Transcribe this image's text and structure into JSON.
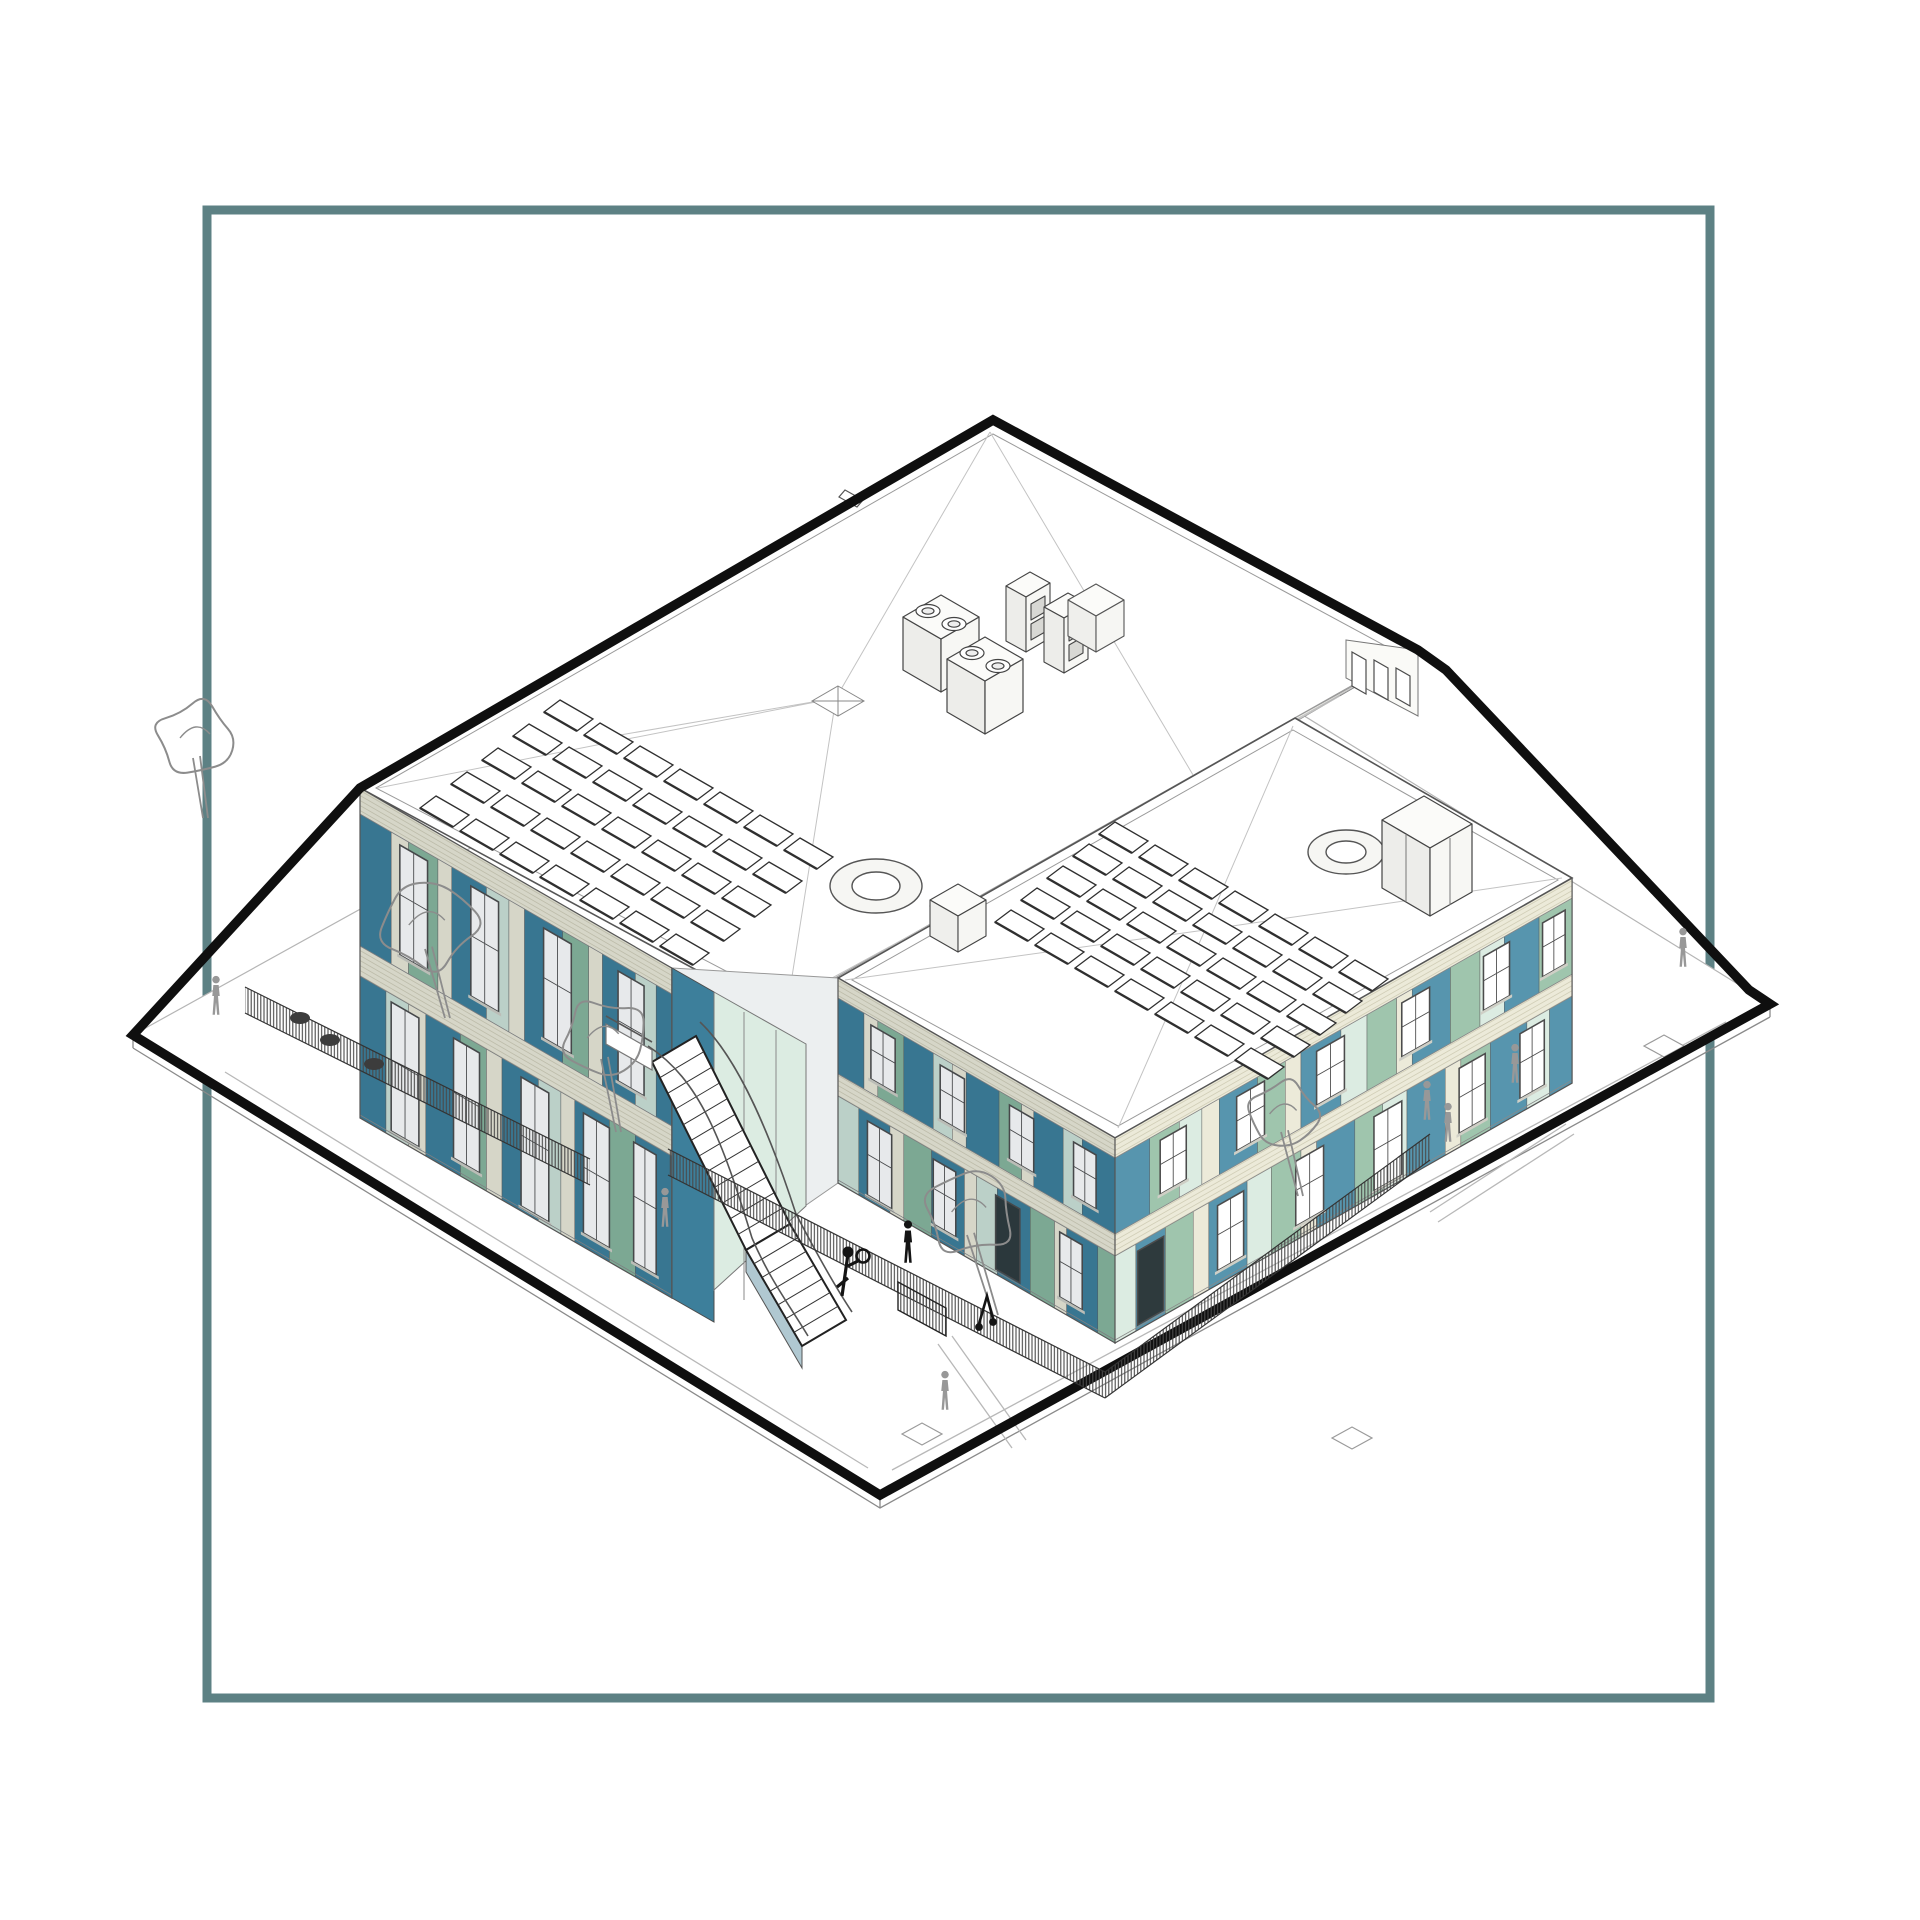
{
  "meta": {
    "label": "Axonometric architectural drawing of a two-storey L-shaped building with coloured facade panels, rooftop solar panels and plant, fenced play areas, trees and people, framed by a square teal border"
  },
  "palette": {
    "background": "#ffffff",
    "frame": "#5d8184",
    "ink": "#0f0f0f",
    "line": "#444444",
    "line_light": "#9a9a9a",
    "roof_line": "#c3c3c3",
    "roof_fill": "#ffffff",
    "teal": "#3d7f9b",
    "teal_light": "#5795ae",
    "sage": "#88b79e",
    "sage_light": "#9fc5ad",
    "mint": "#cfe4d8",
    "mint_light": "#dcece2",
    "cream": "#ecead9",
    "cream_hatch": "#d2cfb8",
    "window_frame": "#4c4c4c",
    "door_dark": "#2e3a3d",
    "person": "#989898",
    "figure_dark": "#141414",
    "tree": "#8c8c8c",
    "fence": "#4a4a4a",
    "stair_side": "#b0c8d1"
  },
  "frame": {
    "x": 207,
    "y": 210,
    "w": 1503,
    "h": 1488,
    "thickness": 9
  },
  "site": {
    "plate": [
      [
        133,
        1035
      ],
      [
        1023,
        542
      ],
      [
        1770,
        1004
      ],
      [
        880,
        1495
      ]
    ],
    "boundary": [
      [
        133,
        1035
      ],
      [
        360,
        788
      ],
      [
        993,
        420
      ],
      [
        1418,
        650
      ],
      [
        1446,
        670
      ],
      [
        1749,
        990
      ],
      [
        1770,
        1004
      ],
      [
        880,
        1495
      ]
    ],
    "boundary_width": 9.5
  },
  "roofs": {
    "main": {
      "outer": [
        [
          993,
          420
        ],
        [
          1418,
          650
        ],
        [
          785,
          1018
        ],
        [
          360,
          788
        ]
      ],
      "inner": [
        [
          993,
          434
        ],
        [
          1404,
          656
        ],
        [
          789,
          1004
        ],
        [
          376,
          788
        ]
      ]
    },
    "wing": {
      "outer": [
        [
          1295,
          718
        ],
        [
          1572,
          878
        ],
        [
          1115,
          1138
        ],
        [
          838,
          978
        ]
      ],
      "inner": [
        [
          1293,
          730
        ],
        [
          1558,
          880
        ],
        [
          1118,
          1126
        ],
        [
          852,
          980
        ]
      ]
    },
    "clerestory_strip": [
      [
        1418,
        650
      ],
      [
        785,
        1018
      ],
      [
        838,
        978
      ],
      [
        1295,
        718
      ]
    ],
    "clerestory_tower": [
      [
        1346,
        640
      ],
      [
        1418,
        650
      ],
      [
        1418,
        716
      ],
      [
        1346,
        678
      ]
    ]
  },
  "faces": [
    {
      "name": "main-southwest-facade",
      "matrix": [
        0.866,
        0.5,
        0,
        1,
        360,
        788
      ],
      "w": 360,
      "h": 330,
      "shade": 0.1,
      "bands": {
        "parapet": [
          0,
          26
        ],
        "upper": [
          26,
          158
        ],
        "mid": [
          158,
          188
        ],
        "lower": [
          188,
          330
        ]
      },
      "upper_panels": [
        [
          0,
          36,
          "teal"
        ],
        [
          36,
          20,
          "cream"
        ],
        [
          56,
          34,
          "sage"
        ],
        [
          90,
          16,
          "cream"
        ],
        [
          106,
          40,
          "teal"
        ],
        [
          146,
          26,
          "mint"
        ],
        [
          172,
          18,
          "cream"
        ],
        [
          190,
          44,
          "teal"
        ],
        [
          234,
          30,
          "sage"
        ],
        [
          264,
          16,
          "cream"
        ],
        [
          280,
          38,
          "teal"
        ],
        [
          318,
          24,
          "mint"
        ],
        [
          342,
          18,
          "teal"
        ]
      ],
      "upper_windows": [
        [
          46,
          32,
          "win"
        ],
        [
          128,
          32,
          "win"
        ],
        [
          212,
          32,
          "win"
        ],
        [
          298,
          30,
          "win"
        ]
      ],
      "lower_panels": [
        [
          0,
          30,
          "teal"
        ],
        [
          30,
          26,
          "mint"
        ],
        [
          56,
          20,
          "cream"
        ],
        [
          76,
          40,
          "teal"
        ],
        [
          116,
          30,
          "sage"
        ],
        [
          146,
          18,
          "cream"
        ],
        [
          164,
          42,
          "teal"
        ],
        [
          206,
          26,
          "mint"
        ],
        [
          232,
          16,
          "cream"
        ],
        [
          248,
          40,
          "teal"
        ],
        [
          288,
          30,
          "sage"
        ],
        [
          318,
          42,
          "teal"
        ]
      ],
      "lower_windows": [
        [
          36,
          32,
          "door"
        ],
        [
          108,
          30,
          "win"
        ],
        [
          186,
          32,
          "door"
        ],
        [
          258,
          30,
          "win"
        ],
        [
          316,
          26,
          "win"
        ]
      ]
    },
    {
      "name": "east-wing-southwest-facade",
      "matrix": [
        0.866,
        0.5,
        0,
        1,
        838,
        978
      ],
      "w": 320,
      "h": 205,
      "shade": 0.1,
      "bands": {
        "parapet": [
          0,
          20
        ],
        "upper": [
          20,
          96
        ],
        "mid": [
          96,
          118
        ],
        "lower": [
          118,
          205
        ]
      },
      "upper_panels": [
        [
          0,
          30,
          "teal"
        ],
        [
          30,
          16,
          "cream"
        ],
        [
          46,
          30,
          "sage"
        ],
        [
          76,
          34,
          "teal"
        ],
        [
          110,
          22,
          "mint"
        ],
        [
          132,
          16,
          "cream"
        ],
        [
          148,
          38,
          "teal"
        ],
        [
          186,
          26,
          "sage"
        ],
        [
          212,
          14,
          "cream"
        ],
        [
          226,
          34,
          "teal"
        ],
        [
          260,
          22,
          "mint"
        ],
        [
          282,
          38,
          "teal"
        ]
      ],
      "upper_windows": [
        [
          38,
          28,
          "win"
        ],
        [
          118,
          28,
          "win"
        ],
        [
          198,
          28,
          "win"
        ],
        [
          272,
          26,
          "win"
        ]
      ],
      "lower_panels": [
        [
          0,
          24,
          "mint"
        ],
        [
          24,
          36,
          "teal"
        ],
        [
          60,
          16,
          "cream"
        ],
        [
          76,
          32,
          "sage"
        ],
        [
          108,
          38,
          "teal"
        ],
        [
          146,
          14,
          "cream"
        ],
        [
          160,
          24,
          "mint"
        ],
        [
          184,
          38,
          "teal"
        ],
        [
          222,
          28,
          "sage"
        ],
        [
          250,
          14,
          "cream"
        ],
        [
          264,
          36,
          "teal"
        ],
        [
          300,
          20,
          "sage"
        ]
      ],
      "lower_windows": [
        [
          34,
          28,
          "door"
        ],
        [
          110,
          26,
          "win"
        ],
        [
          182,
          28,
          "darkdoor"
        ],
        [
          256,
          26,
          "win"
        ]
      ]
    },
    {
      "name": "east-wing-southeast-facade",
      "matrix": [
        0.869,
        -0.494,
        0,
        1,
        1115,
        1138
      ],
      "w": 526,
      "h": 205,
      "shade": 0,
      "bands": {
        "parapet": [
          0,
          20
        ],
        "upper": [
          20,
          96
        ],
        "mid": [
          96,
          118
        ],
        "lower": [
          118,
          205
        ]
      },
      "upper_panels": [
        [
          0,
          40,
          "teal_light"
        ],
        [
          40,
          34,
          "sage_light"
        ],
        [
          74,
          26,
          "mint_light"
        ],
        [
          100,
          20,
          "cream"
        ],
        [
          120,
          44,
          "teal_light"
        ],
        [
          164,
          32,
          "sage_light"
        ],
        [
          196,
          18,
          "cream"
        ],
        [
          214,
          46,
          "teal_light"
        ],
        [
          260,
          30,
          "mint_light"
        ],
        [
          290,
          34,
          "sage_light"
        ],
        [
          324,
          18,
          "cream"
        ],
        [
          342,
          44,
          "teal_light"
        ],
        [
          386,
          34,
          "sage_light"
        ],
        [
          420,
          28,
          "mint_light"
        ],
        [
          448,
          40,
          "teal_light"
        ],
        [
          488,
          38,
          "sage_light"
        ]
      ],
      "upper_windows": [
        [
          52,
          30,
          "win"
        ],
        [
          140,
          32,
          "win"
        ],
        [
          232,
          32,
          "win"
        ],
        [
          330,
          32,
          "win"
        ],
        [
          424,
          30,
          "win"
        ],
        [
          492,
          26,
          "win"
        ]
      ],
      "lower_panels": [
        [
          0,
          24,
          "mint_light"
        ],
        [
          24,
          34,
          "teal_light"
        ],
        [
          58,
          32,
          "sage_light"
        ],
        [
          90,
          18,
          "cream"
        ],
        [
          108,
          44,
          "teal_light"
        ],
        [
          152,
          28,
          "mint_light"
        ],
        [
          180,
          34,
          "sage_light"
        ],
        [
          214,
          18,
          "cream"
        ],
        [
          232,
          44,
          "teal_light"
        ],
        [
          276,
          32,
          "sage_light"
        ],
        [
          308,
          28,
          "mint_light"
        ],
        [
          336,
          44,
          "teal_light"
        ],
        [
          380,
          18,
          "cream"
        ],
        [
          398,
          34,
          "sage_light"
        ],
        [
          432,
          42,
          "teal_light"
        ],
        [
          474,
          26,
          "mint_light"
        ],
        [
          500,
          26,
          "teal_light"
        ]
      ],
      "lower_windows": [
        [
          26,
          30,
          "darkdoor"
        ],
        [
          118,
          30,
          "win"
        ],
        [
          208,
          32,
          "win"
        ],
        [
          298,
          32,
          "door"
        ],
        [
          396,
          30,
          "win"
        ],
        [
          466,
          28,
          "win"
        ]
      ]
    }
  ],
  "solar_arrays": [
    {
      "name": "main-roof-solar-array",
      "origin": [
        560,
        700
      ],
      "cols": 7,
      "rows": 5,
      "col_step": [
        40,
        23
      ],
      "row_step": [
        -31,
        24
      ],
      "panel_a": [
        33,
        19
      ],
      "panel_t": [
        -16,
        12
      ]
    },
    {
      "name": "wing-roof-solar-array",
      "origin": [
        1115,
        822
      ],
      "cols": 7,
      "rows": 5,
      "col_step": [
        40,
        23
      ],
      "row_step": [
        -26,
        22
      ],
      "panel_a": [
        33,
        19
      ],
      "panel_t": [
        -16,
        12
      ]
    }
  ],
  "stair": {
    "flights": [
      {
        "l1": [
          652,
          1062
        ],
        "r1": [
          696,
          1036
        ],
        "l2": [
          746,
          1250
        ],
        "r2": [
          790,
          1224
        ],
        "steps": 12
      },
      {
        "l1": [
          746,
          1250
        ],
        "r1": [
          790,
          1224
        ],
        "l2": [
          802,
          1346
        ],
        "r2": [
          846,
          1320
        ],
        "steps": 7
      }
    ]
  },
  "trees": [
    {
      "x": 196,
      "y": 738,
      "r": 40,
      "tx": 205,
      "ty": 818
    },
    {
      "x": 428,
      "y": 925,
      "r": 48,
      "tx": 447,
      "ty": 1018
    },
    {
      "x": 604,
      "y": 1038,
      "r": 42,
      "tx": 618,
      "ty": 1132
    },
    {
      "x": 970,
      "y": 1212,
      "r": 46,
      "tx": 995,
      "ty": 1315
    },
    {
      "x": 1284,
      "y": 1114,
      "r": 36,
      "tx": 1300,
      "ty": 1196
    }
  ],
  "people": [
    [
      216,
      1015
    ],
    [
      665,
      1227
    ],
    [
      945,
      1410
    ],
    [
      1427,
      1120
    ],
    [
      1448,
      1142
    ],
    [
      1515,
      1083
    ],
    [
      1683,
      967
    ]
  ],
  "figures_dark": [
    {
      "type": "pole",
      "x": 848,
      "y": 1296
    },
    {
      "type": "person",
      "x": 908,
      "y": 1262
    },
    {
      "type": "scooter",
      "x": 984,
      "y": 1322
    }
  ],
  "fences": [
    {
      "pts": [
        [
          245,
          1013
        ],
        [
          590,
          1185
        ]
      ],
      "h": 26
    },
    {
      "pts": [
        [
          668,
          1175
        ],
        [
          1105,
          1398
        ],
        [
          1430,
          1160
        ]
      ],
      "h": 26
    }
  ],
  "gate": [
    [
      898,
      1282
    ],
    [
      946,
      1308
    ],
    [
      946,
      1336
    ],
    [
      898,
      1310
    ]
  ],
  "planters": [
    [
      300,
      1018
    ],
    [
      330,
      1040
    ],
    [
      374,
      1064
    ]
  ],
  "pads": [
    [
      452,
      1023
    ],
    [
      812,
      1164
    ],
    [
      922,
      1434
    ],
    [
      1352,
      1438
    ],
    [
      1664,
      1046
    ]
  ],
  "ground_paths": [
    [
      [
        225,
        1072
      ],
      [
        868,
        1468
      ]
    ],
    [
      [
        892,
        1470
      ],
      [
        1726,
        1022
      ]
    ],
    [
      [
        938,
        1344
      ],
      [
        1012,
        1448
      ]
    ],
    [
      [
        952,
        1336
      ],
      [
        1026,
        1440
      ]
    ],
    [
      [
        1430,
        1212
      ],
      [
        1566,
        1124
      ]
    ],
    [
      [
        1438,
        1222
      ],
      [
        1574,
        1134
      ]
    ]
  ]
}
